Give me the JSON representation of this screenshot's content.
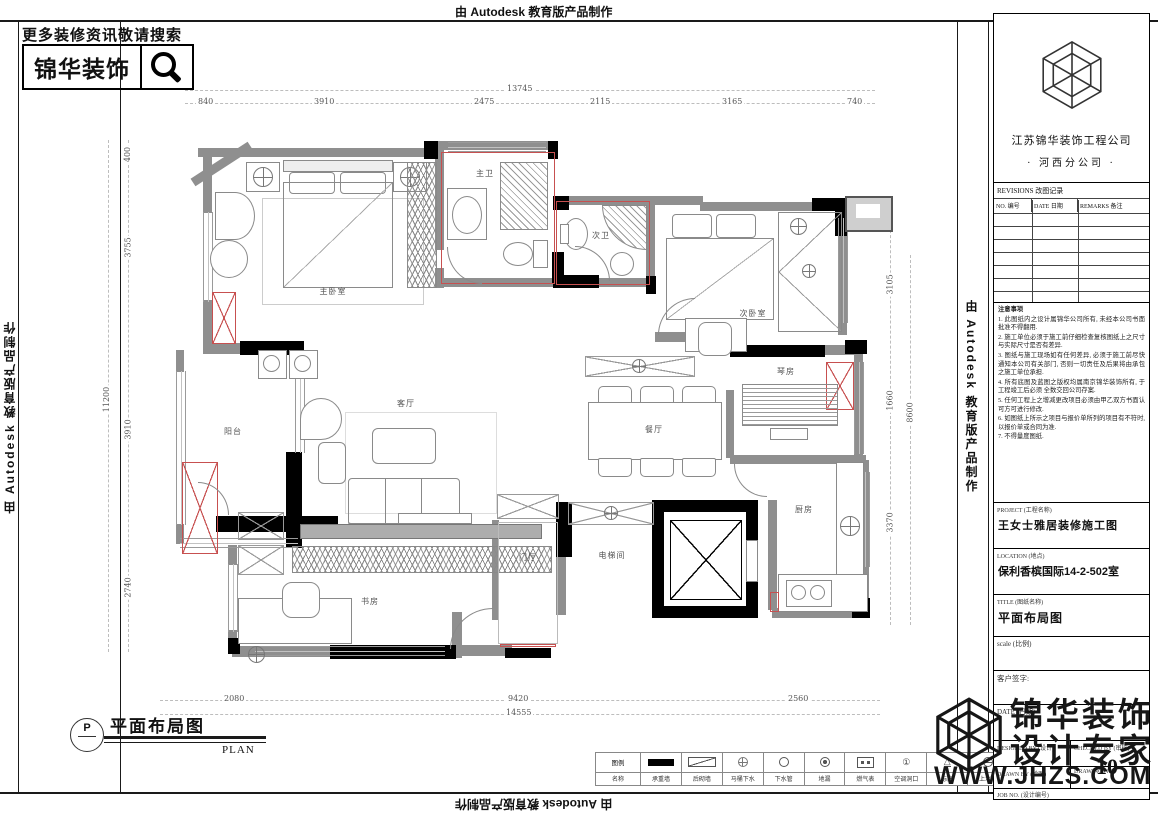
{
  "banner": {
    "text": "由 Autodesk 教育版产品制作"
  },
  "promo": {
    "hint": "更多装修资讯敬请搜索",
    "brand": "锦华装饰"
  },
  "company": {
    "name": "江苏锦华装饰工程公司",
    "branch": "· 河西分公司 ·"
  },
  "revisions": {
    "title": "REVISIONS 改图记录",
    "col_no": "NO. 编号",
    "col_date": "DATE 日期",
    "col_remarks": "REMARKS 备注"
  },
  "notes": {
    "title": "注意事项",
    "items": [
      "1. 此图纸内之设计属锦华公司所有, 未经本公司书面批准不得翻用.",
      "2. 施工单位必须于施工前仔细检查复核图纸上之尺寸与实际尺寸是否有差异.",
      "3. 图纸与施工现场如有任何差异, 必须于施工前尽快通知本公司有关部门, 否则一切责任及后果将由承包之施工单位承担.",
      "4. 所有底图及蓝图之版权均属南京锦华装饰所有, 于工程竣工后必须 全数交回公司存案.",
      "5. 任何工程上之增减更改项目必须由甲乙双方书面认可方可进行修改.",
      "6. 如图纸上所示之项目与报价单所列的项目有不符时, 以报价单或合同为准.",
      "7. 不得量度图纸."
    ]
  },
  "titleblock": {
    "project_label": "PROJECT (工程名称)",
    "project": "王女士雅居装修施工图",
    "location_label": "LOCATION (地点)",
    "location": "保利香槟国际14-2-502室",
    "title_label": "TITLE (图纸名称)",
    "title": "平面布局图",
    "scale_label": "scale  (比例)",
    "client_label": "客户签字:",
    "date_label": "DATE (日期)",
    "designed_label": "DESIGNED BY (设计)",
    "checked_label": "CHECKED BY (审核)",
    "drawn_label": "DRAWN BY (绘图)",
    "drawing_no_label": "DRAWING NO.",
    "job_label": "JOB NO. (设计编号)",
    "drawing_no": "10"
  },
  "watermark": {
    "brand": "锦华装饰",
    "tagline": "设计专家",
    "url": "WWW.JHZS.COM"
  },
  "plan_title": {
    "letter": "P",
    "zh": "平面布局图",
    "en": "PLAN"
  },
  "legend": {
    "header_top": "图例",
    "header_bottom": "名称",
    "items": [
      {
        "label": "承重墙"
      },
      {
        "label": "后砌墙"
      },
      {
        "label": "马桶下水"
      },
      {
        "label": "下水管"
      },
      {
        "label": "地漏"
      },
      {
        "label": "燃气表"
      },
      {
        "label": "空调洞口"
      },
      {
        "label": "标高"
      },
      {
        "label": "上水位"
      }
    ]
  },
  "rooms": [
    {
      "name": "主卧室"
    },
    {
      "name": "主卫"
    },
    {
      "name": "次卫"
    },
    {
      "name": "次卧室"
    },
    {
      "name": "阳台"
    },
    {
      "name": "客厅"
    },
    {
      "name": "餐厅"
    },
    {
      "name": "琴房"
    },
    {
      "name": "厨房"
    },
    {
      "name": "书房"
    },
    {
      "name": "门厅"
    },
    {
      "name": "电梯间"
    }
  ],
  "dims": {
    "top_total": "13745",
    "top": [
      "840",
      "3910",
      "2475",
      "2115",
      "3165",
      "740"
    ],
    "left_total": "11200",
    "left": [
      "400",
      "3755",
      "3910",
      "2740"
    ],
    "right_total": "8600",
    "right": [
      "3105",
      "1660",
      "3370"
    ],
    "bottom_total": "14555",
    "bottom": [
      "2080",
      "9420",
      "2560"
    ]
  },
  "colors": {
    "wall_gray": "#8f8f8f",
    "wall_black": "#000000",
    "accent_red": "#c75050"
  }
}
